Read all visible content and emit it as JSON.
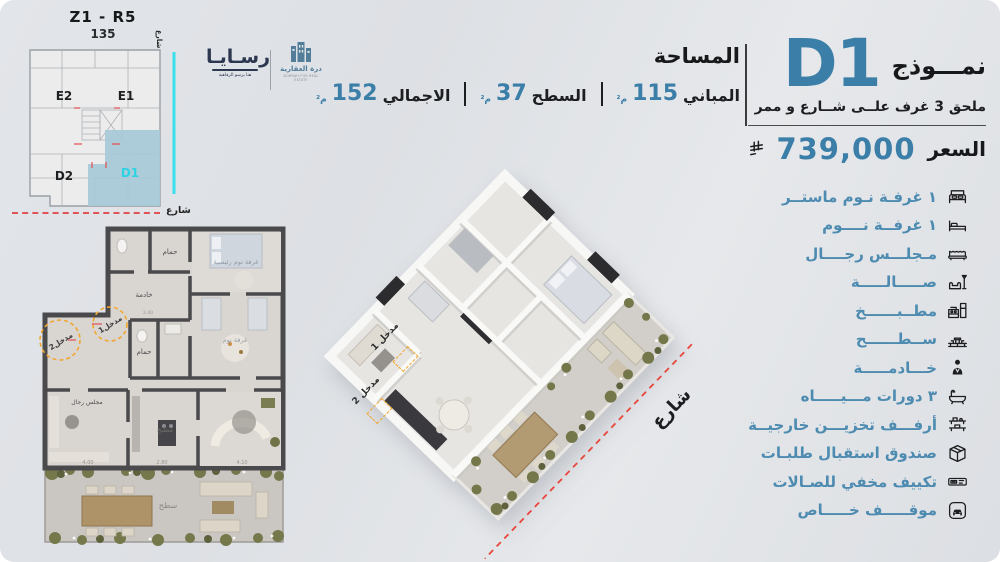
{
  "meta": {
    "colors": {
      "background": "#dfe2e6",
      "accent_blue": "#3b7ea8",
      "feature_blue": "#4d8bb0",
      "cyan": "#2ed3e3",
      "entrance_orange": "#f0a630",
      "street_red": "#e05356"
    }
  },
  "site_plan": {
    "zone": "Z1 - R5",
    "number": "135",
    "units": {
      "e2": "E2",
      "e1": "E1",
      "d2": "D2",
      "d1": "D1"
    },
    "street_side": "شارع",
    "street_bottom": "شارع"
  },
  "logos": {
    "rasaya_name": "رسـايـا",
    "rasaya_tagline": "هنا يرسو الرفاهية",
    "dorrah_name": "درة العقارية",
    "dorrah_sub": "DORRAH FOR REAL ESTATE"
  },
  "area": {
    "title": "المساحة",
    "stats": [
      {
        "label": "المباني",
        "value": "115",
        "unit": "م²"
      },
      {
        "label": "السطح",
        "value": "37",
        "unit": "م²"
      },
      {
        "label": "الاجمالي",
        "value": "152",
        "unit": "م²"
      }
    ]
  },
  "model": {
    "label": "نمـــوذج",
    "code": "D1",
    "subtitle": "ملحق 3 غرف علــى شــارع و ممر",
    "price_label": "السعر",
    "price_value": "739,000",
    "currency_icon": "saudi-riyal-symbol"
  },
  "features": {
    "items": [
      {
        "icon": "master-bed-icon",
        "label": "١ غرفـة نـوم ماستــر"
      },
      {
        "icon": "bed-icon",
        "label": "١ غرفــة نــــوم"
      },
      {
        "icon": "majlis-sofa-icon",
        "label": "مـجلـــس رجــــال"
      },
      {
        "icon": "sofa-lamp-icon",
        "label": "صـــــالـــــة"
      },
      {
        "icon": "kitchen-icon",
        "label": "مطــبــــــخ"
      },
      {
        "icon": "roof-terrace-icon",
        "label": "ســطــــــح"
      },
      {
        "icon": "maid-icon",
        "label": "خـــادمـــــة"
      },
      {
        "icon": "bathtub-icon",
        "label": "٣ دورات مـــيـــــاه"
      },
      {
        "icon": "storage-shelf-icon",
        "label": "أرفـــف تخزيـــن خارجيــة"
      },
      {
        "icon": "parcel-box-icon",
        "label": "صندوق استقبال طلبـات"
      },
      {
        "icon": "ac-unit-icon",
        "label": "تكييف مخفي للصـالات"
      },
      {
        "icon": "parking-icon",
        "label": "موقـــــف خـــــاص"
      }
    ]
  },
  "plan2d": {
    "rooms": {
      "bath_top": "حمام",
      "maid": "خادمة",
      "bath_mid": "حمام",
      "master": "غرفة نوم رئيسية",
      "bedroom": "غرفة نوم",
      "majlis": "مجلس رجال",
      "kitchen": "مطبخ",
      "terrace": "سطح"
    },
    "entrance1": "مدخل1",
    "entrance2": "مدخل2",
    "dims": {
      "a": "4.00",
      "b": "2.80",
      "c": "4.10",
      "d": "2.40"
    }
  },
  "plan3d": {
    "entrance1": "مدخل 1",
    "entrance2": "مدخل 2",
    "street": "شارع"
  }
}
